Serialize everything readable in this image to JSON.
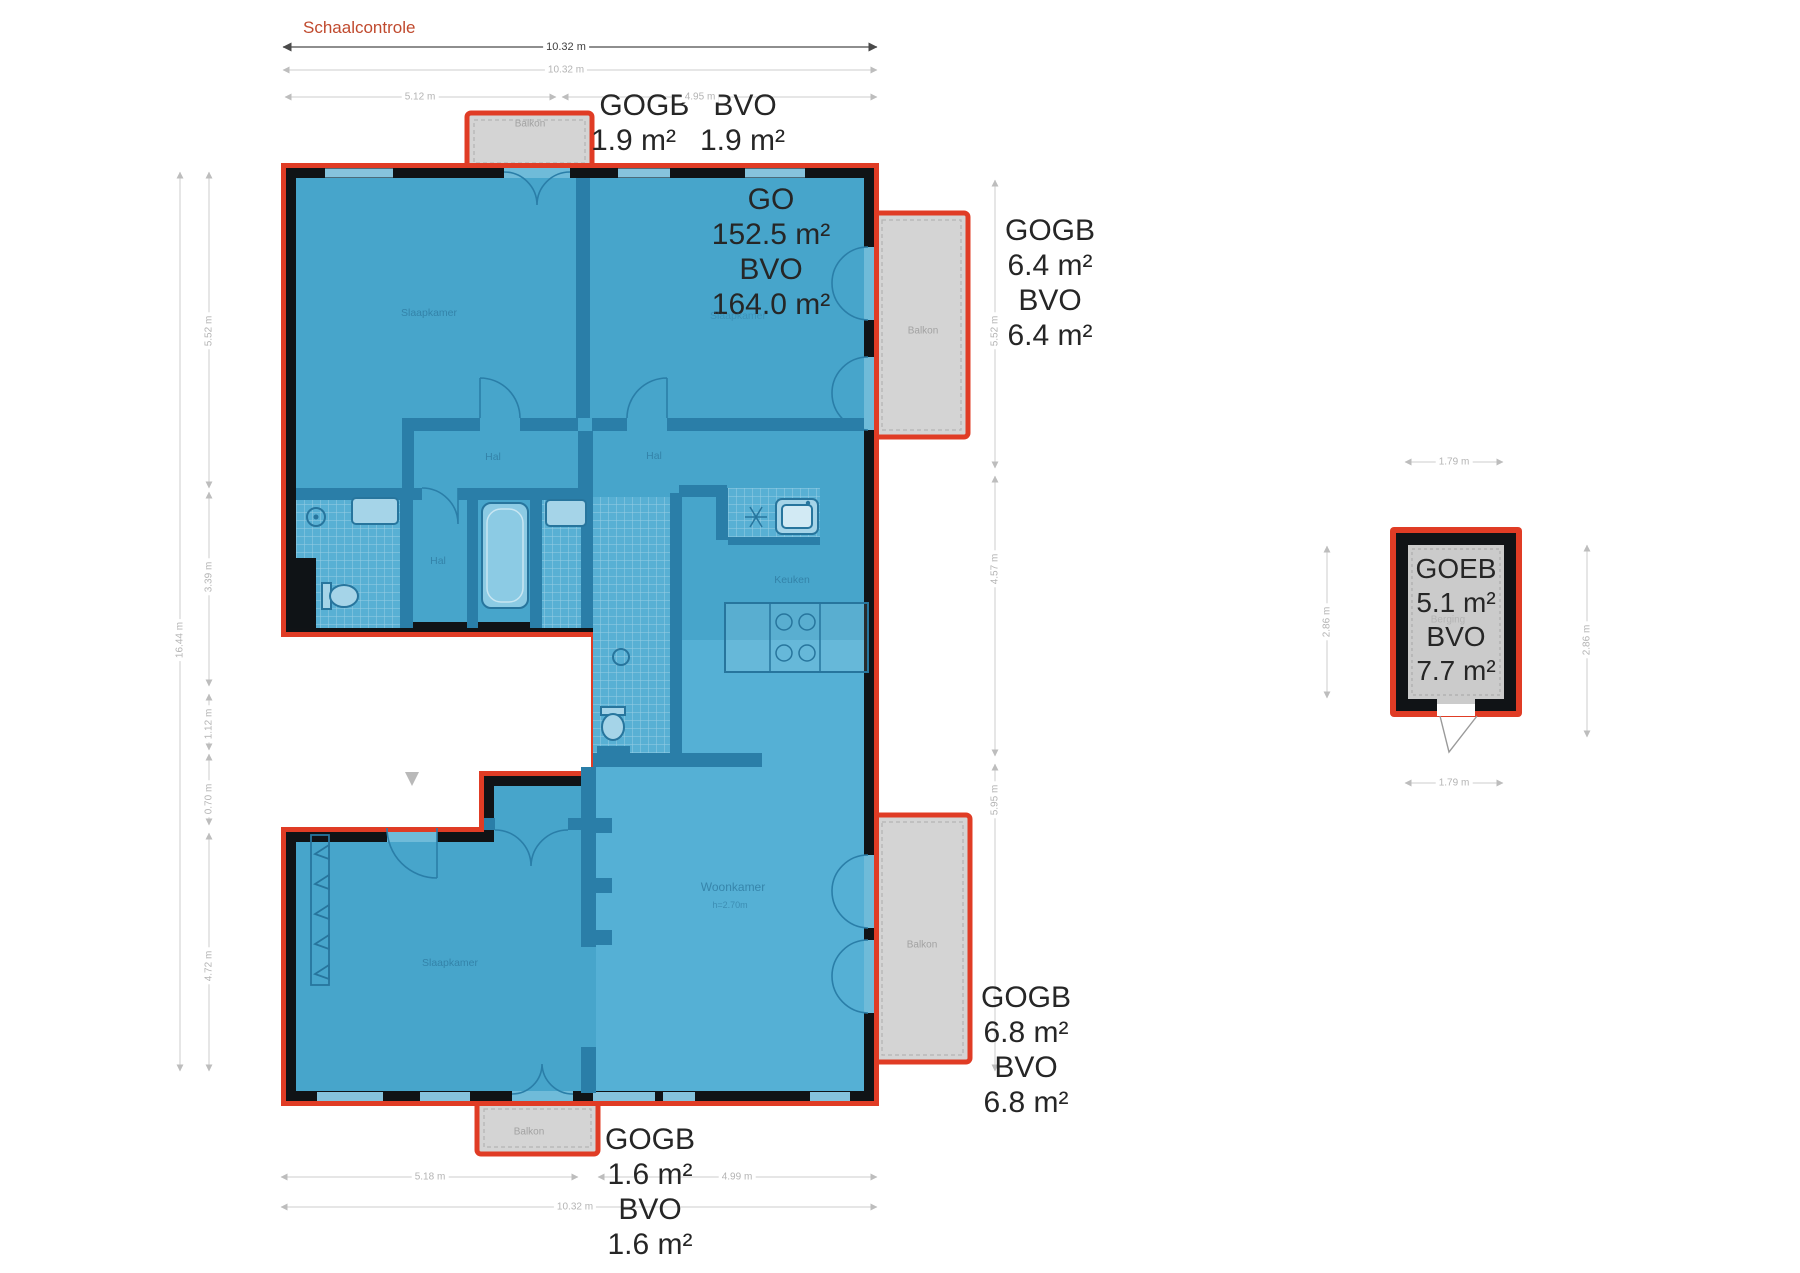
{
  "title": {
    "scale_check": "Schaalcontrole"
  },
  "colors": {
    "outline_red": "#e03c25",
    "wall_black": "#101316",
    "room_blue": "#47a5cb",
    "room_blue_light": "#55b0d5",
    "wall_blue": "#2a7ea8",
    "balcony_gray": "#d4d4d4",
    "dim_gray": "#cdcdcd",
    "area_label_dark": "#262626",
    "room_label_blue": "#2f7ba1",
    "balcony_label_gray": "#a2a2a2"
  },
  "areas": {
    "balcony_top": {
      "name1": "GOGB",
      "value1": "1.9 m²",
      "name2": "BVO",
      "value2": "1.9 m²"
    },
    "main": {
      "name1": "GO",
      "value1": "152.5 m²",
      "name2": "BVO",
      "value2": "164.0 m²"
    },
    "balcony_right_top": {
      "name1": "GOGB",
      "value1": "6.4 m²",
      "name2": "BVO",
      "value2": "6.4 m²"
    },
    "balcony_right_bottom": {
      "name1": "GOGB",
      "value1": "6.8 m²",
      "name2": "BVO",
      "value2": "6.8 m²"
    },
    "balcony_bottom": {
      "name1": "GOGB",
      "value1": "1.6 m²",
      "name2": "BVO",
      "value2": "1.6 m²"
    },
    "outbuilding": {
      "name1": "GOEB",
      "value1": "5.1 m²",
      "name2": "BVO",
      "value2": "7.7 m²"
    }
  },
  "rooms": {
    "bedroom1": "Slaapkamer",
    "bedroom2": "Slaapkamer",
    "bedroom3": "Slaapkamer",
    "hall1": "Hal",
    "hall2": "Hal",
    "hall3": "Hal",
    "kitchen": "Keuken",
    "living": "Woonkamer",
    "living_height": "h=2.70m",
    "balcony": "Balkon",
    "storage": "Berging"
  },
  "dimensions": {
    "top": {
      "total": "10.32 m",
      "total_light": "10.32 m",
      "seg1": "5.12 m",
      "seg2": "4.95 m"
    },
    "bottom": {
      "seg1": "5.18 m",
      "seg2": "4.99 m",
      "total": "10.32 m"
    },
    "left": {
      "total": "16.44 m",
      "seg1": "5.52 m",
      "seg2": "3.39 m",
      "seg3": "1.12 m",
      "seg4": "0.70 m",
      "seg5": "4.72 m"
    },
    "right": {
      "seg1": "5.52 m",
      "seg2": "4.57 m",
      "seg3": "5.95 m"
    },
    "outbuilding": {
      "top": "1.79 m",
      "bottom": "1.79 m",
      "left": "2.86 m",
      "right": "2.86 m"
    }
  }
}
